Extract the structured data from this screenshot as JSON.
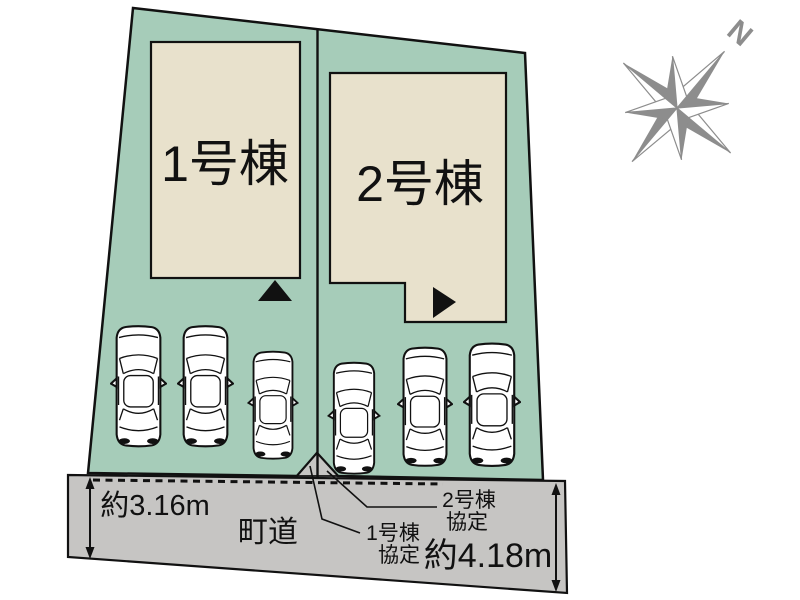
{
  "diagram": {
    "type": "real-estate-site-plan",
    "plot": {
      "building1_label": "1号棟",
      "building2_label": "2号棟",
      "car_count": 6
    },
    "road": {
      "label": "町道",
      "width_left": "約3.16m",
      "width_right": "約4.18m"
    },
    "agreements": {
      "building1_line1": "1号棟",
      "building1_line2": "協定",
      "building2_line1": "2号棟",
      "building2_line2": "協定"
    },
    "compass": {
      "north_label": "N"
    }
  },
  "colors": {
    "plot_green": "#a6ccb9",
    "building_fill": "#e8e1cc",
    "road_gray": "#c6c5c3",
    "compass_gray": "#8d8d8d",
    "line_black": "#111111"
  }
}
